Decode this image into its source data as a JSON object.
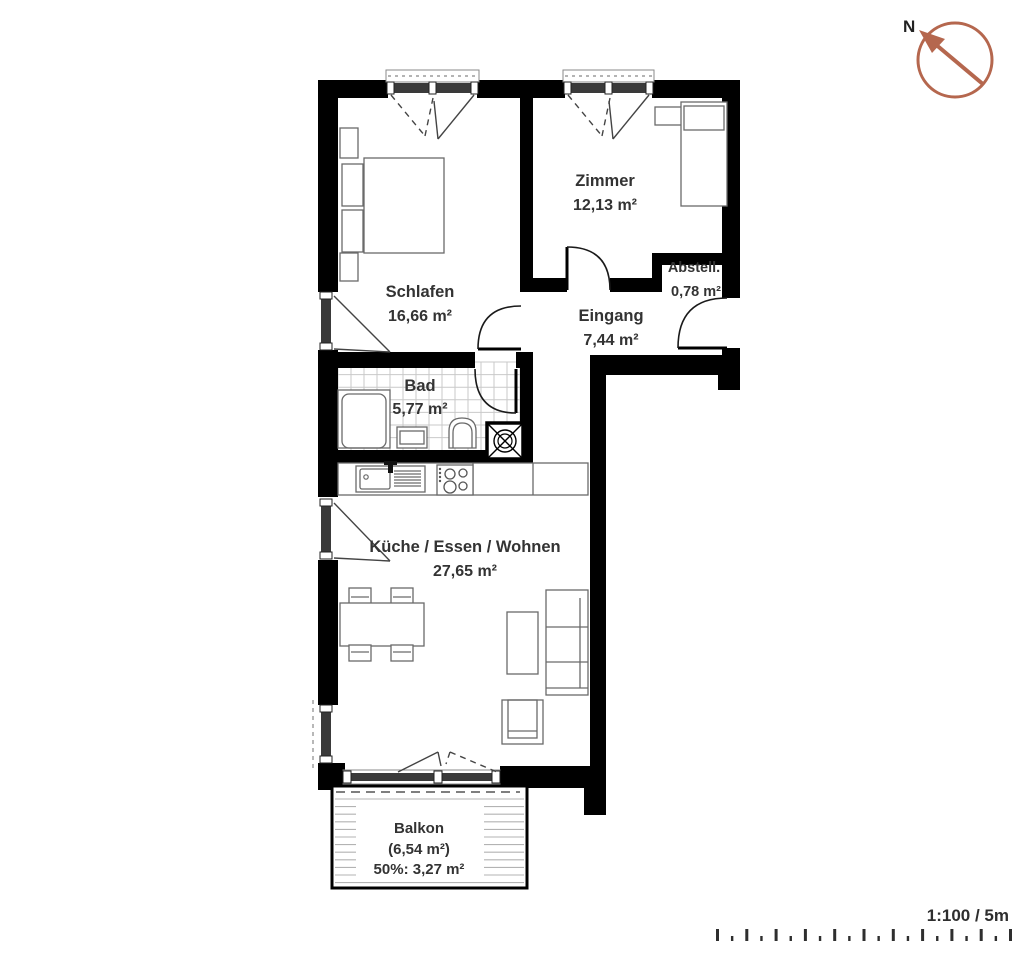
{
  "rooms": {
    "zimmer": {
      "name": "Zimmer",
      "area": "12,13 m²"
    },
    "schlafen": {
      "name": "Schlafen",
      "area": "16,66 m²"
    },
    "abstell": {
      "name": "Abstell.",
      "area": "0,78 m²"
    },
    "eingang": {
      "name": "Eingang",
      "area": "7,44 m²"
    },
    "bad": {
      "name": "Bad",
      "area": "5,77 m²"
    },
    "kueche": {
      "name": "Küche / Essen / Wohnen",
      "area": "27,65 m²"
    },
    "balkon": {
      "name": "Balkon",
      "area": "(6,54 m²)",
      "area_half": "50%: 3,27 m²"
    }
  },
  "compass": {
    "label": "N",
    "direction": "north-west",
    "color": "#b5674e"
  },
  "scale_bar": {
    "label": "1:100 / 5m",
    "tick_count": 21
  },
  "colors": {
    "wall": "#000000",
    "text": "#333333",
    "tile_line": "#c9c9c9",
    "deck_line": "#b3b3b3"
  }
}
